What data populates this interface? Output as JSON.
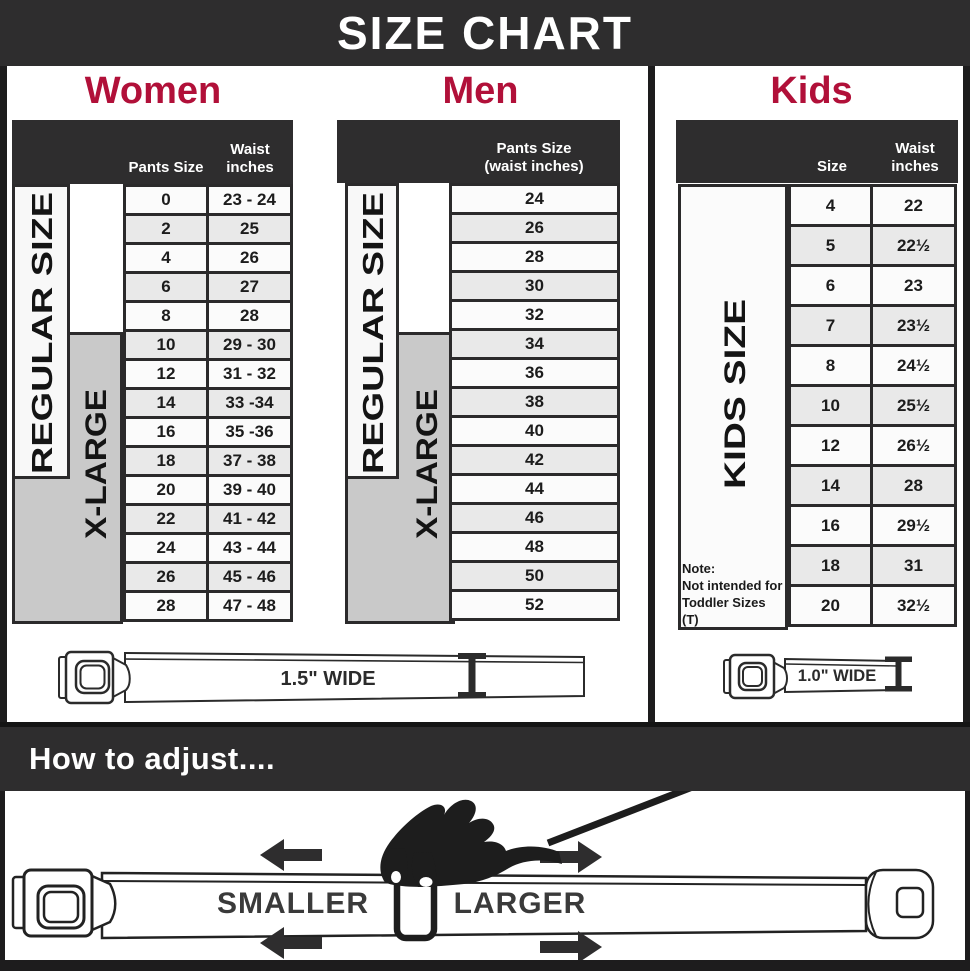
{
  "title": "SIZE CHART",
  "colors": {
    "accent_crimson": "#b11039",
    "bar_dark": "#2e2d2e",
    "xlarge_gray": "#c9c9c9",
    "row_alt_gray": "#e9e9e9"
  },
  "women": {
    "heading": "Women",
    "col_pants": "Pants Size",
    "col_waist": "Waist inches",
    "regular_label": "REGULAR SIZE",
    "xlarge_label": "X-LARGE",
    "rows": [
      [
        "0",
        "23 - 24"
      ],
      [
        "2",
        "25"
      ],
      [
        "4",
        "26"
      ],
      [
        "6",
        "27"
      ],
      [
        "8",
        "28"
      ],
      [
        "10",
        "29 - 30"
      ],
      [
        "12",
        "31 - 32"
      ],
      [
        "14",
        "33 -34"
      ],
      [
        "16",
        "35 -36"
      ],
      [
        "18",
        "37 - 38"
      ],
      [
        "20",
        "39 - 40"
      ],
      [
        "22",
        "41 - 42"
      ],
      [
        "24",
        "43 - 44"
      ],
      [
        "26",
        "45 - 46"
      ],
      [
        "28",
        "47 - 48"
      ]
    ]
  },
  "men": {
    "heading": "Men",
    "col_pants_line1": "Pants Size",
    "col_pants_line2": "(waist inches)",
    "regular_label": "REGULAR SIZE",
    "xlarge_label": "X-LARGE",
    "rows": [
      "24",
      "26",
      "28",
      "30",
      "32",
      "34",
      "36",
      "38",
      "40",
      "42",
      "44",
      "46",
      "48",
      "50",
      "52"
    ],
    "belt_width_label": "1.5\" WIDE"
  },
  "kids": {
    "heading": "Kids",
    "col_size": "Size",
    "col_waist": "Waist inches",
    "side_label": "KIDS SIZE",
    "rows": [
      [
        "4",
        "22"
      ],
      [
        "5",
        "22½"
      ],
      [
        "6",
        "23"
      ],
      [
        "7",
        "23½"
      ],
      [
        "8",
        "24½"
      ],
      [
        "10",
        "25½"
      ],
      [
        "12",
        "26½"
      ],
      [
        "14",
        "28"
      ],
      [
        "16",
        "29½"
      ],
      [
        "18",
        "31"
      ],
      [
        "20",
        "32½"
      ]
    ],
    "note_line1": "Note:",
    "note_line2": "Not intended for",
    "note_line3": "Toddler Sizes (T)",
    "belt_width_label": "1.0\" WIDE"
  },
  "adjust": {
    "heading": "How to adjust....",
    "smaller_label": "SMALLER",
    "larger_label": "LARGER"
  }
}
